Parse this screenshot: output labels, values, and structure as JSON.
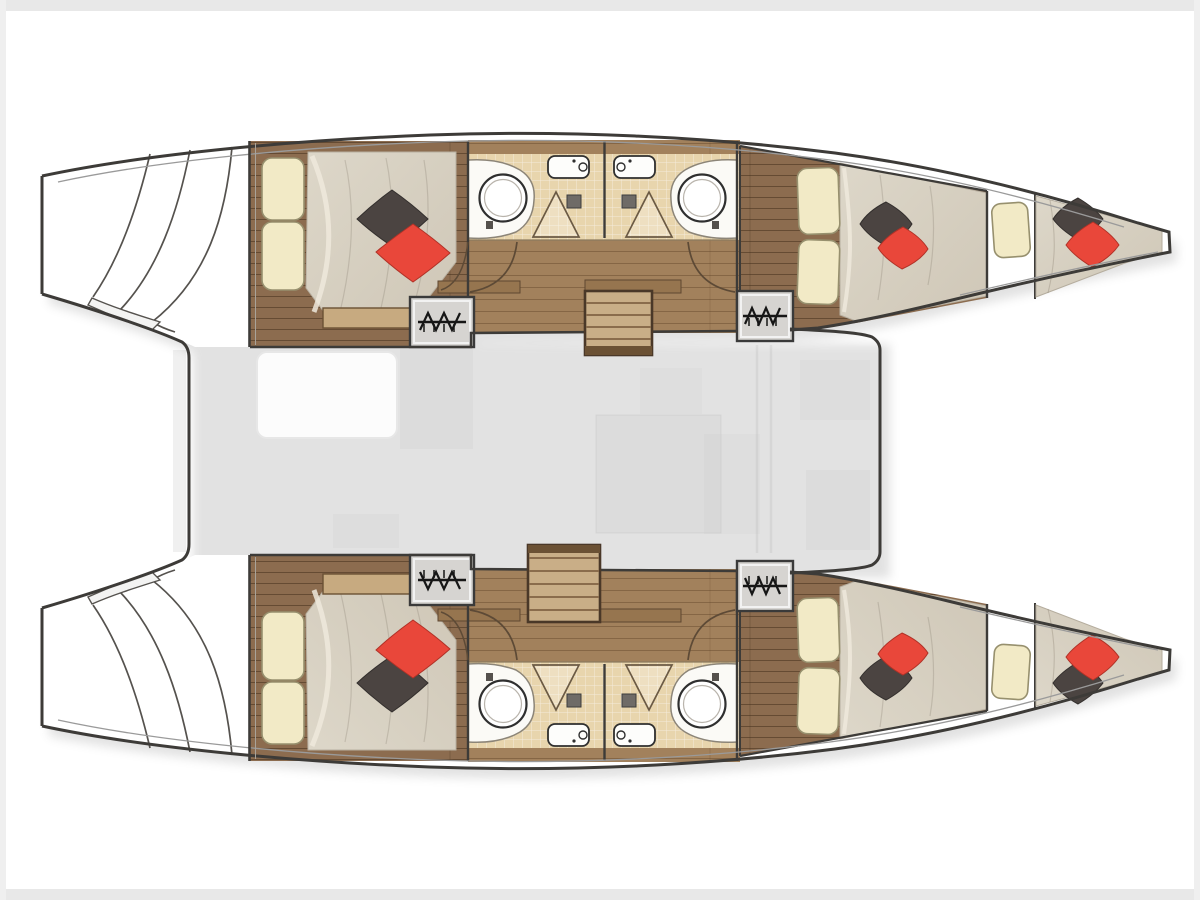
{
  "meta": {
    "title": "Catamaran yacht interior layout floor plan",
    "view": "top-down deck plan, bows pointing right, no visible text labels"
  },
  "palette": {
    "outline": "#3d3b38",
    "toe_line": "#9a9a9a",
    "wood_dark": "#8c6c4f",
    "wood_light": "#a2815c",
    "tile": "#e8d5ad",
    "duvet": "#d8d1c3",
    "pillow_cream": "#f2eac6",
    "pillow_dark": "#4b4441",
    "pillow_red": "#e9473a",
    "hatch_box": "#d6d4d1",
    "stair_tread": "#c9ae87",
    "stair_edge": "#5d4733",
    "frame_band": "#e8e8e8"
  },
  "plan": {
    "hulls": [
      {
        "label": "port hull (top)",
        "rooms": [
          {
            "label": "aft double cabin with bed, two cream pillows, dark and red accent pillows"
          },
          {
            "label": "bathroom with round sink, shower, tub and toilet"
          },
          {
            "label": "second bathroom mirrored with round sink, shower and tub"
          },
          {
            "label": "forward double cabin with bed and accent pillows"
          },
          {
            "label": "forepeak berth in bow tip with cream pillow and accent pillows"
          }
        ],
        "hatches": 2,
        "transom": "aft swim steps with curved lines"
      },
      {
        "label": "starboard hull (bottom)",
        "rooms": [
          {
            "label": "aft double cabin with bed, two cream pillows, dark and red accent pillows"
          },
          {
            "label": "bathroom with round sink, shower, tub and toilet"
          },
          {
            "label": "second bathroom mirrored with round sink, shower and tub"
          },
          {
            "label": "forward double cabin with bed and accent pillows"
          },
          {
            "label": "forepeak berth in bow tip with cream pillow and accent pillows"
          }
        ],
        "hatches": 2,
        "transom": "aft swim steps with curved lines"
      }
    ],
    "bridgedeck": {
      "label": "central salon and cockpit (shown faint)",
      "features": [
        {
          "label": "companionway stairs to port hull"
        },
        {
          "label": "companionway stairs to starboard hull"
        },
        {
          "label": "aft platform between transoms"
        },
        {
          "label": "forward beam wall between bows"
        },
        {
          "label": "faint cockpit table and salon furniture"
        }
      ]
    },
    "counts": {
      "cabins": 4,
      "forepeak_berths": 2,
      "bathrooms": 4,
      "sinks": 4,
      "stairs": 2,
      "hatches": 4
    }
  }
}
